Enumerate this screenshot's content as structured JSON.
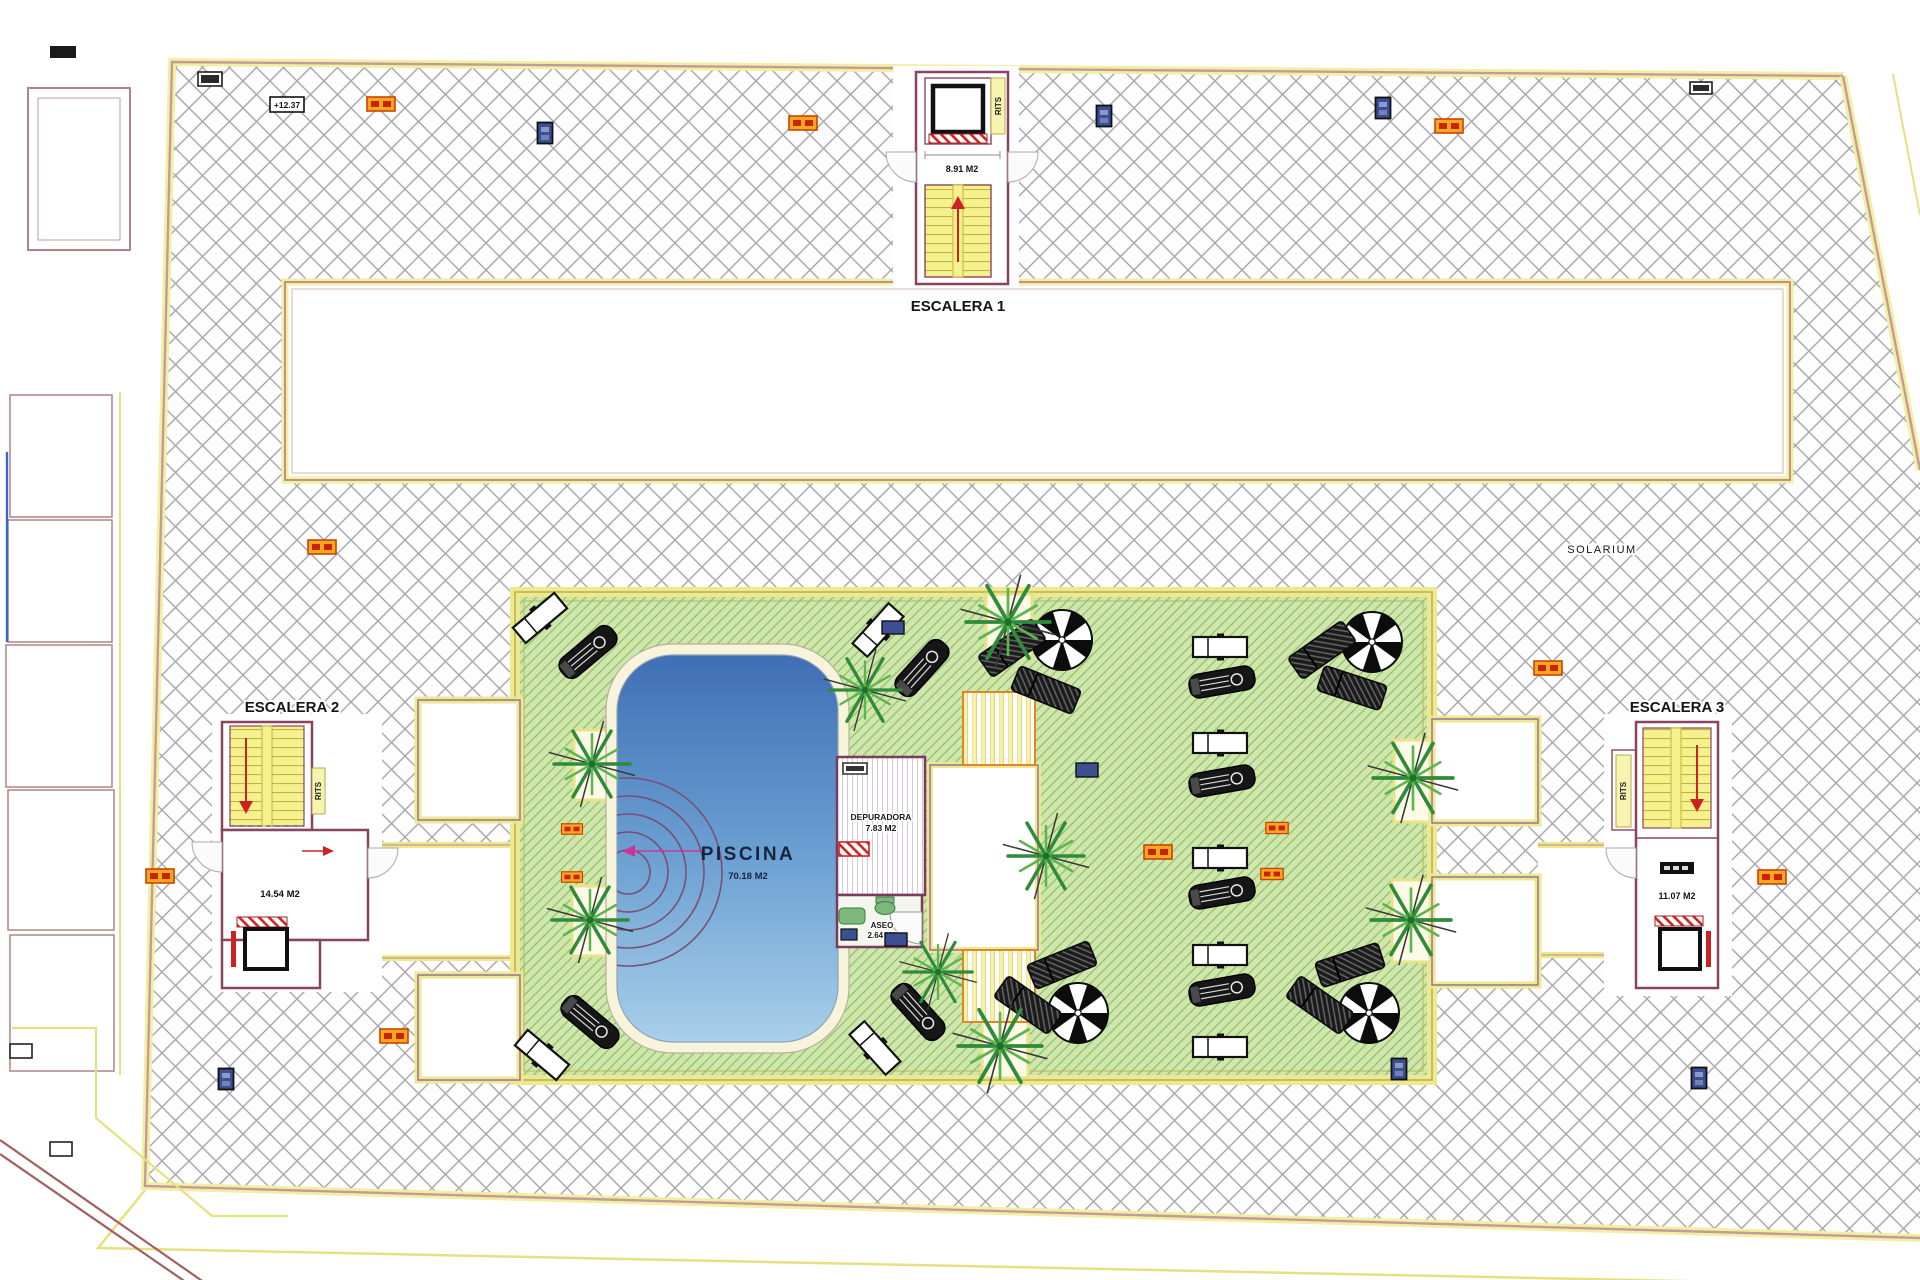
{
  "plan": {
    "solarium_label": "SOLARIUM",
    "elevation_marker": "+12.37",
    "escalera1": {
      "title": "ESCALERA 1",
      "area": "8.91 M2",
      "shaft": "RITS"
    },
    "escalera2": {
      "title": "ESCALERA 2",
      "area": "14.54 M2",
      "shaft": "RITS"
    },
    "escalera3": {
      "title": "ESCALERA 3",
      "area": "11.07 M2",
      "shaft": "RITS"
    },
    "piscina": {
      "title": "PISCINA",
      "area": "70.18 M2"
    },
    "depuradora": {
      "title": "DEPURADORA",
      "area": "7.83 M2"
    },
    "aseo": {
      "title": "ASEO",
      "area": "2.64 M2"
    }
  },
  "colors": {
    "hatch_line": "#a6a6ae",
    "boundary_yellow": "#f3efa2",
    "boundary_maroon": "#c49a9a",
    "wall_maroon": "#8b4460",
    "terrace_green": "#cfe7ac",
    "terrace_green_line": "#8fbd68",
    "stair_yellow": "#f5f18f",
    "pool_blue_top": "#3f6fb4",
    "pool_blue_bottom": "#a9cfe9",
    "pool_deck": "#f8f4dc",
    "marker_orange": "#f5a623",
    "marker_blue": "#3b4f91",
    "accent_red": "#cc2222"
  }
}
